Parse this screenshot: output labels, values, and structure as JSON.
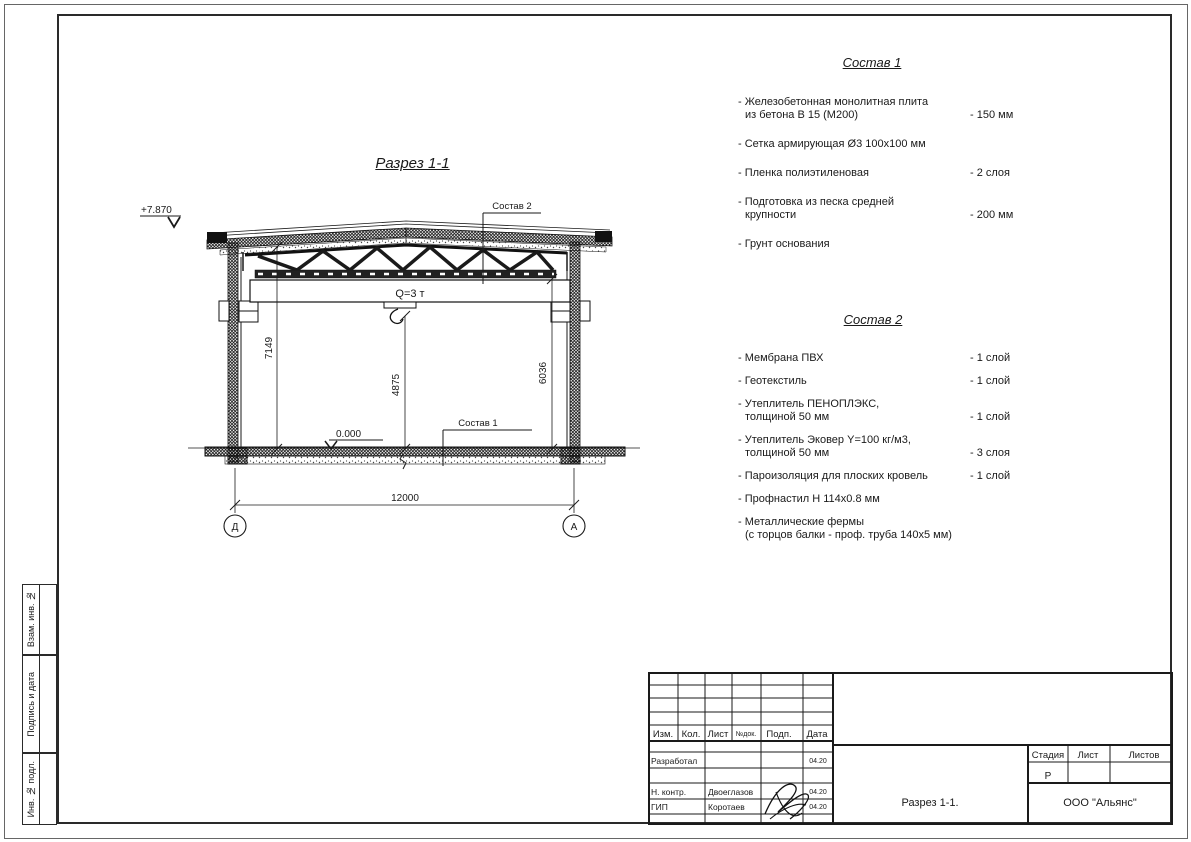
{
  "ink": "#1a1a1a",
  "paper": "#ffffff",
  "drawing": {
    "view_title": "Разрез 1-1",
    "elevation_top": "+7.870",
    "elevation_zero": "0.000",
    "crane_label": "Q=3 т",
    "leader_sostav1": "Состав 1",
    "leader_sostav2": "Состав 2",
    "dim_left": "7149",
    "dim_center": "4875",
    "dim_right": "6036",
    "dim_span": "12000",
    "axis_left": "Д",
    "axis_right": "А"
  },
  "sostav1": {
    "title": "Состав 1",
    "items": [
      {
        "line1": "- Железобетонная  монолитная плита",
        "line2": "из бетона В 15 (М200)",
        "value": "- 150 мм"
      },
      {
        "line1": "- Сетка армирующая Ø3 100х100 мм",
        "line2": "",
        "value": ""
      },
      {
        "line1": "- Пленка полиэтиленовая",
        "line2": "",
        "value": "-  2 слоя"
      },
      {
        "line1": "- Подготовка из песка средней",
        "line2": "крупности",
        "value": "- 200 мм"
      },
      {
        "line1": "- Грунт основания",
        "line2": "",
        "value": ""
      }
    ]
  },
  "sostav2": {
    "title": "Состав 2",
    "items": [
      {
        "line1": "- Мембрана ПВХ",
        "line2": "",
        "value": "- 1 слой"
      },
      {
        "line1": "- Геотекстиль",
        "line2": "",
        "value": "- 1 слой"
      },
      {
        "line1": "- Утеплитель ПЕНОПЛЭКС,",
        "line2": "толщиной 50 мм",
        "value": "- 1 слой"
      },
      {
        "line1": "- Утеплитель Эковер Y=100 кг/м3,",
        "line2": "толщиной 50 мм",
        "value": "- 3 слоя"
      },
      {
        "line1": "- Пароизоляция для плоских кровель",
        "line2": "",
        "value": "- 1 слой"
      },
      {
        "line1": "- Профнастил Н 114х0.8 мм",
        "line2": "",
        "value": ""
      },
      {
        "line1": "- Металлические фермы",
        "line2": "(с торцов балки - проф. труба 140х5 мм)",
        "value": ""
      }
    ]
  },
  "titleblock": {
    "header": [
      "Изм.",
      "Кол.",
      "Лист",
      "№док.",
      "Подп.",
      "Дата"
    ],
    "rows": [
      {
        "role": "Разработал",
        "name": "",
        "date": "04.20"
      },
      {
        "role": "Н. контр.",
        "name": "Двоеглазов",
        "date": "04.20"
      },
      {
        "role": "ГИП",
        "name": "Коротаев",
        "date": "04.20"
      }
    ],
    "stage_label": "Стадия",
    "sheet_label": "Лист",
    "sheets_label": "Листов",
    "stage_value": "Р",
    "doc_title": "Разрез 1-1.",
    "company": "ООО \"Альянс\""
  },
  "side_labels": [
    "Взам. инв. №",
    "Подпись и дата",
    "Инв. № подл."
  ]
}
